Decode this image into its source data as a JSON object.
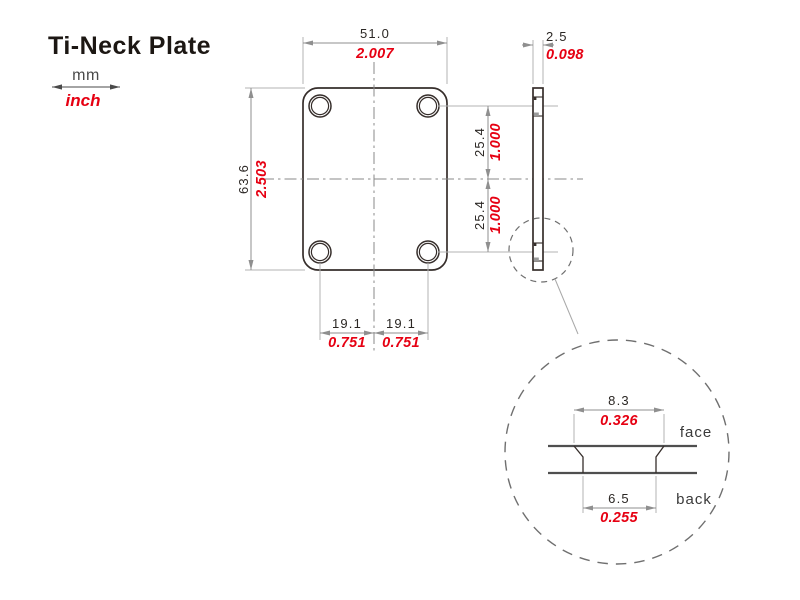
{
  "title": "Ti-Neck Plate",
  "legend": {
    "top_label": "mm",
    "bottom_label": "inch"
  },
  "dimensions": {
    "plate_width": {
      "mm": "51.0",
      "inch": "2.007"
    },
    "plate_height": {
      "mm": "63.6",
      "inch": "2.503"
    },
    "hole_spacing_vertical": {
      "mm": "25.4",
      "inch": "1.000"
    },
    "hole_spacing_horizontal": {
      "mm": "19.1",
      "inch": "0.751"
    },
    "thickness": {
      "mm": "2.5",
      "inch": "0.098"
    },
    "countersink_face_diameter": {
      "mm": "8.3",
      "inch": "0.326"
    },
    "hole_back_diameter": {
      "mm": "6.5",
      "inch": "0.255"
    }
  },
  "detail_labels": {
    "face": "face",
    "back": "back"
  },
  "colors": {
    "accent_red": "#e60012",
    "drawing_line": "#362e2b",
    "dimension_gray": "#8f8f8f",
    "text_black": "#2b2724"
  }
}
